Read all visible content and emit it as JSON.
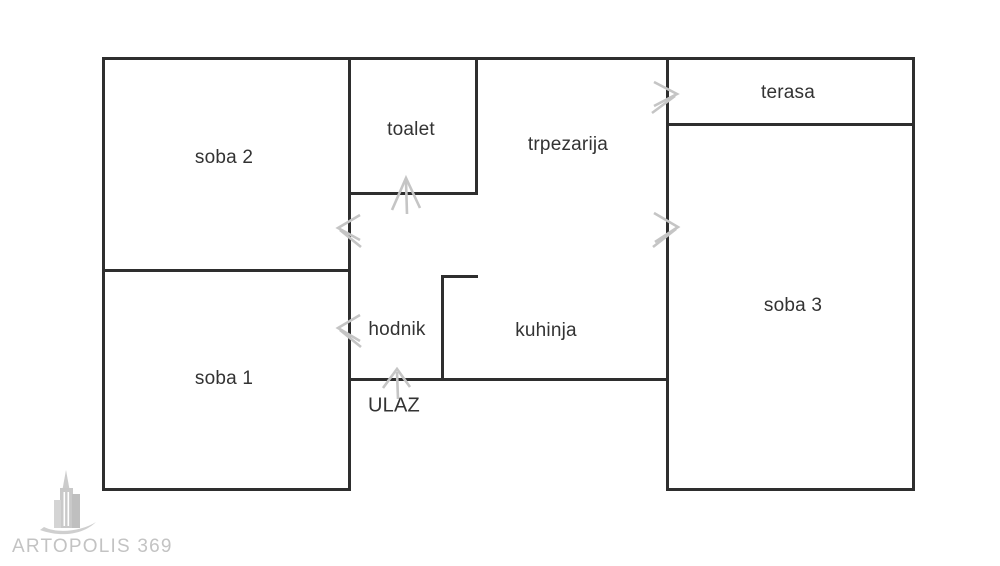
{
  "plan": {
    "canvas": {
      "width": 1000,
      "height": 566,
      "background": "#ffffff"
    },
    "colors": {
      "wall": "#2e2e2e",
      "label": "#333333",
      "door_symbol": "#c5c5c5",
      "watermark": "#c3c3c3"
    },
    "rooms": [
      {
        "id": "soba2",
        "label": "soba 2",
        "cx": 224,
        "cy": 158,
        "caps": false
      },
      {
        "id": "toalet",
        "label": "toalet",
        "cx": 411,
        "cy": 130,
        "caps": false
      },
      {
        "id": "trpezarija",
        "label": "trpezarija",
        "cx": 568,
        "cy": 145,
        "caps": false
      },
      {
        "id": "terasa",
        "label": "terasa",
        "cx": 788,
        "cy": 93,
        "caps": false
      },
      {
        "id": "soba3",
        "label": "soba 3",
        "cx": 793,
        "cy": 306,
        "caps": false
      },
      {
        "id": "soba1",
        "label": "soba 1",
        "cx": 224,
        "cy": 379,
        "caps": false
      },
      {
        "id": "hodnik",
        "label": "hodnik",
        "cx": 397,
        "cy": 330,
        "caps": false
      },
      {
        "id": "kuhinja",
        "label": "kuhinja",
        "cx": 546,
        "cy": 331,
        "caps": false
      },
      {
        "id": "ulaz",
        "label": "ULAZ",
        "cx": 394,
        "cy": 406,
        "caps": true
      }
    ],
    "walls": [
      {
        "name": "outer-top",
        "x": 102,
        "y": 57,
        "w": 813,
        "h": 3
      },
      {
        "name": "outer-left",
        "x": 102,
        "y": 57,
        "w": 3,
        "h": 434
      },
      {
        "name": "outer-right",
        "x": 912,
        "y": 57,
        "w": 3,
        "h": 434
      },
      {
        "name": "soba2-soba1-divider",
        "x": 102,
        "y": 269,
        "w": 249,
        "h": 3
      },
      {
        "name": "mid-vertical-left",
        "x": 348,
        "y": 57,
        "w": 3,
        "h": 434
      },
      {
        "name": "toalet-right",
        "x": 475,
        "y": 57,
        "w": 3,
        "h": 138
      },
      {
        "name": "toalet-bottom",
        "x": 348,
        "y": 192,
        "w": 130,
        "h": 3
      },
      {
        "name": "mid-vertical-right",
        "x": 666,
        "y": 57,
        "w": 3,
        "h": 434
      },
      {
        "name": "terasa-bottom",
        "x": 666,
        "y": 123,
        "w": 249,
        "h": 3
      },
      {
        "name": "soba1-bottom",
        "x": 102,
        "y": 488,
        "w": 249,
        "h": 3
      },
      {
        "name": "soba3-bottom",
        "x": 666,
        "y": 488,
        "w": 249,
        "h": 3
      },
      {
        "name": "hodnik-kuhinja-bottom",
        "x": 348,
        "y": 378,
        "w": 321,
        "h": 3
      },
      {
        "name": "kuhinja-partition-v",
        "x": 441,
        "y": 275,
        "w": 3,
        "h": 106
      },
      {
        "name": "kuhinja-partition-h",
        "x": 441,
        "y": 275,
        "w": 37,
        "h": 3
      }
    ],
    "doors": [
      {
        "name": "door-toalet",
        "direction": "up",
        "chevron": "392,210 406,178 420,208",
        "tail": "406,181 407,214"
      },
      {
        "name": "door-soba2",
        "direction": "left",
        "chevron": "360,215 338,228 360,240",
        "tail": "340,230 361,247"
      },
      {
        "name": "door-terasa",
        "direction": "right",
        "chevron": "654,82 677,94 654,106",
        "tail": "675,96 652,113"
      },
      {
        "name": "door-soba3",
        "direction": "right",
        "chevron": "654,213 678,227 655,242",
        "tail": "676,229 653,247"
      },
      {
        "name": "door-soba1",
        "direction": "left",
        "chevron": "360,315 338,328 360,341",
        "tail": "340,330 361,347"
      },
      {
        "name": "door-ulaz",
        "direction": "up",
        "chevron": "383,388 397,369 410,387",
        "tail": "397,372 398,399"
      }
    ],
    "watermark": {
      "text": "ARTOPOLIS 369"
    }
  }
}
